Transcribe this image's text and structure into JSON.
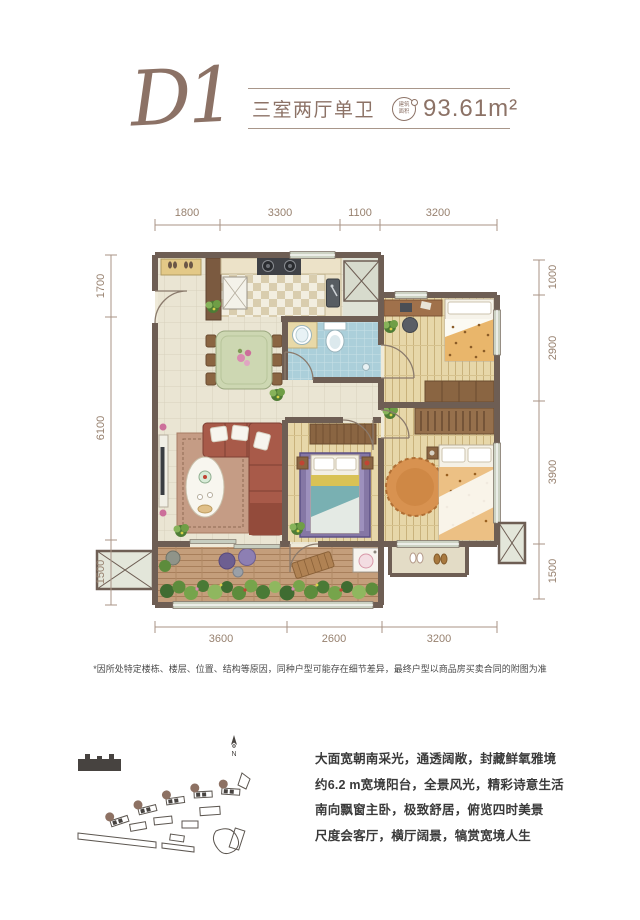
{
  "header": {
    "plan_code": "D1",
    "layout_type": "三室两厅单卫",
    "area_badge": {
      "line1": "建筑",
      "line2": "面积"
    },
    "area_value": "93.61m²"
  },
  "plan": {
    "dims": {
      "top": [
        "1800",
        "3300",
        "1100",
        "3200"
      ],
      "bottom": [
        "3600",
        "2600",
        "3200"
      ],
      "left": [
        "1700",
        "6100",
        "1500"
      ],
      "right": [
        "1000",
        "2900",
        "3900",
        "1500"
      ]
    }
  },
  "disclaimer": "*因所处特定楼栋、楼层、位置、结构等原因，同种户型可能存在细节差异，最终户型以商品房买卖合同的附图为准",
  "site_plan": {
    "north_label": "N"
  },
  "description": {
    "lines": [
      "大面宽朝南采光，通透阔敞，封藏鲜氧雅境",
      "约6.2 m宽境阳台，全景风光，精彩诗意生活",
      "南向飘窗主卧，极致舒居，俯览四时美景",
      "尺度会客厅，横厅阔景，犒赏宽境人生"
    ]
  },
  "colors": {
    "accent": "#8c7266",
    "wall": "#6e5e54",
    "body_text": "#3a3a3a"
  }
}
